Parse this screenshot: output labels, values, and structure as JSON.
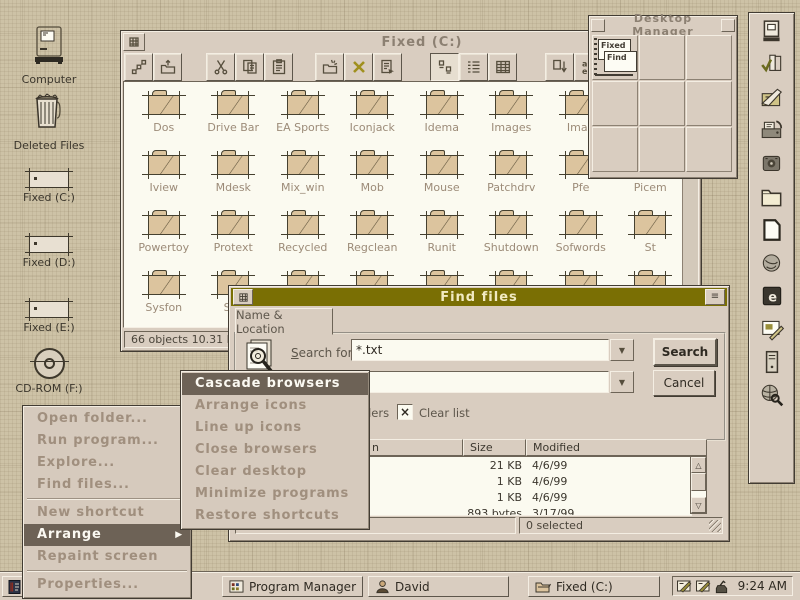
{
  "desktop_icons": [
    {
      "label": "Computer"
    },
    {
      "label": "Deleted Files"
    },
    {
      "label": "Fixed (C:)"
    },
    {
      "label": "Fixed (D:)"
    },
    {
      "label": "Fixed (E:)"
    },
    {
      "label": "CD-ROM (F:)"
    }
  ],
  "browser": {
    "title": "Fixed (C:)",
    "toolbar_icons": [
      "shortcut",
      "up-one-level",
      "cut",
      "copy",
      "paste",
      "new-folder",
      "delete",
      "properties",
      "large-icons-view",
      "list-view",
      "details-view",
      "sort-by-type",
      "sort-by-name",
      "sort-by-size",
      "sort-by-date"
    ],
    "rows": [
      [
        "Dos",
        "Drive Bar",
        "EA Sports",
        "Iconjack",
        "Idema",
        "Images",
        "Imag",
        ""
      ],
      [
        "Iview",
        "Mdesk",
        "Mix_win",
        "Mob",
        "Mouse",
        "Patchdrv",
        "Pfe",
        "Picem"
      ],
      [
        "Powertoy",
        "Protext",
        "Recycled",
        "Regclean",
        "Runit",
        "Shutdown",
        "Sofwords",
        "St"
      ],
      [
        "Sysfon",
        "Sys",
        "",
        "",
        "",
        "",
        "",
        ""
      ]
    ],
    "status": "66 objects  10.31 M"
  },
  "desktop_manager": {
    "title": "Desktop Manager",
    "mini_windows": [
      "Fixed",
      "Find"
    ]
  },
  "sidebar_icons": [
    "computer",
    "organizer",
    "notepad",
    "fax",
    "recorder",
    "folder",
    "blank-page",
    "globe-sculpture",
    "e-floppy",
    "paint",
    "tower-pc",
    "web-search"
  ],
  "find_dialog": {
    "title": "Find files",
    "tab": "Name & Location",
    "search_label_key": "S",
    "search_label_rest": "earch for:",
    "search_value": "*.txt",
    "search_button": "Search",
    "cancel_button": "Cancel",
    "subfolders_fragment": "ders",
    "clear_list": "Clear list",
    "header_fragment": "n",
    "col_size": "Size",
    "col_modified": "Modified",
    "rows": [
      {
        "size": "21 KB",
        "modified": "4/6/99"
      },
      {
        "size": "1 KB",
        "modified": "4/6/99"
      },
      {
        "size": "1 KB",
        "modified": "4/6/99"
      },
      {
        "size": "893 bytes",
        "modified": "3/17/99"
      }
    ],
    "items_found": "766 items found",
    "selected": "0 selected"
  },
  "context_menu": {
    "items": [
      "Open folder...",
      "Run program...",
      "Explore...",
      "Find files...",
      "New shortcut",
      "Arrange",
      "Repaint screen",
      "Properties..."
    ]
  },
  "arrange_submenu": {
    "items": [
      "Cascade browsers",
      "Arrange icons",
      "Line up icons",
      "Close browsers",
      "Clear desktop",
      "Minimize programs",
      "Restore shortcuts"
    ]
  },
  "taskbar": {
    "tasks": [
      "Program Manager",
      "David",
      "Fixed (C:)"
    ],
    "clock": "9:24 AM"
  },
  "colors": {
    "desktop": "#cdc2a6",
    "face": "#d9cdc0",
    "titlebar_active": "#7a6f04",
    "titlebar_text": "#f1eac2",
    "menu_highlight": "#6d6256",
    "menu_text": "#a08f7e"
  }
}
